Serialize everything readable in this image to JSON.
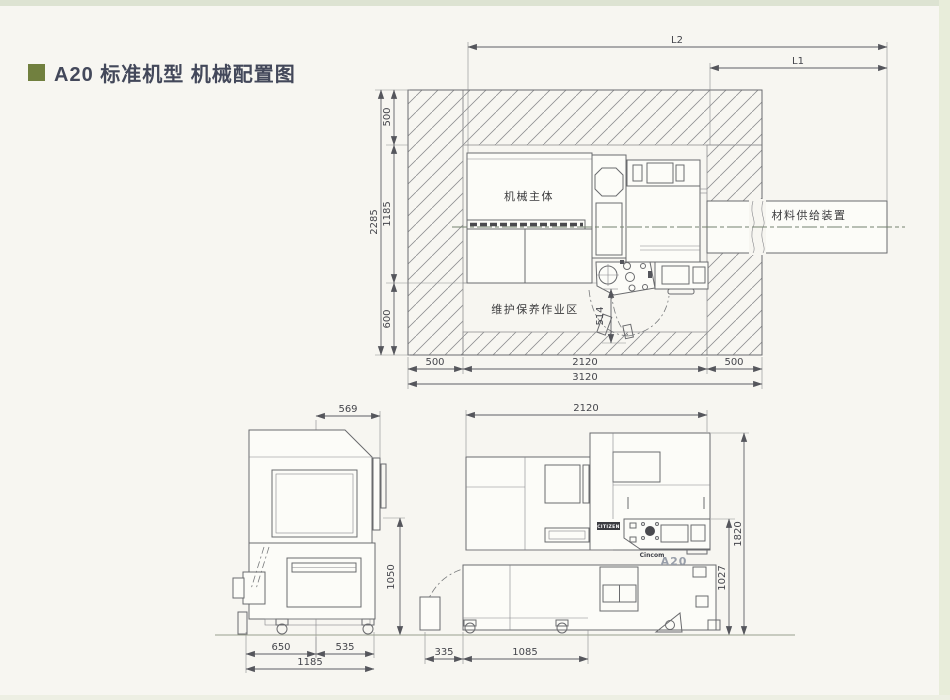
{
  "page": {
    "title": "A20 标准机型 机械配置图"
  },
  "plan_view": {
    "labels": {
      "machine_body": "机械主体",
      "maintenance_area": "维护保养作业区",
      "material_supply": "材料供给装置"
    },
    "dims": {
      "l2": "L2",
      "l1": "L1",
      "top_clearance": "500",
      "total_depth": "2285",
      "body_depth": "1185",
      "front_clearance": "600",
      "door_opening": "514",
      "left_clearance": "500",
      "body_width": "2120",
      "right_clearance": "500",
      "total_width": "3120"
    }
  },
  "side_view": {
    "dims": {
      "spindle_offset": "569",
      "height": "1050",
      "front_span": "650",
      "rear_span": "535",
      "total_length": "1185"
    }
  },
  "front_view": {
    "labels": {
      "brand_plate": "CITIZEN",
      "logo_brand": "Cincom",
      "logo_model": "A20"
    },
    "dims": {
      "width": "2120",
      "total_height": "1820",
      "cover_height": "1027",
      "left_extension": "335",
      "base_length": "1085"
    }
  }
}
